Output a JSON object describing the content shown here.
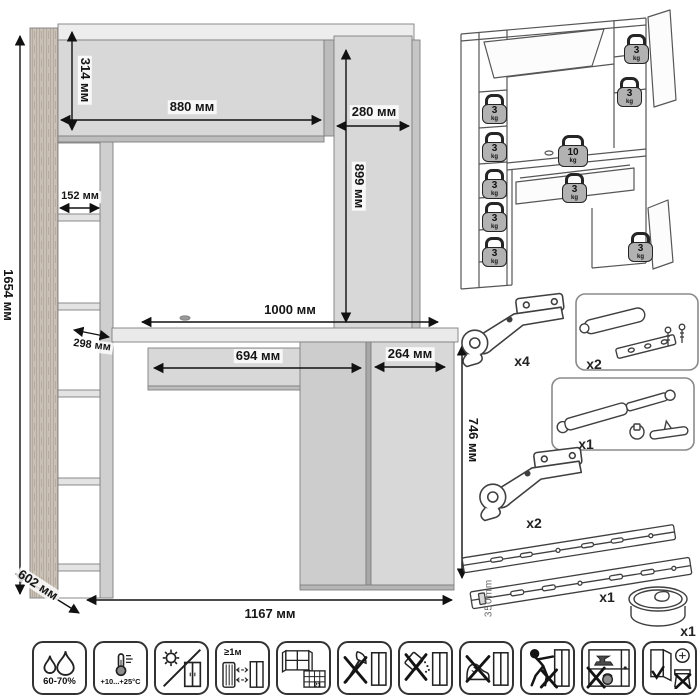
{
  "dims": {
    "total_height": "1654 мм",
    "hutch_height": "314 мм",
    "hutch_width": "880 мм",
    "cabinet_width": "280 мм",
    "shelf_width": "152 мм",
    "cabinet_height": "899 мм",
    "shelf_depth": "298 мм",
    "desktop_width": "1000 мм",
    "drawer_width": "694 мм",
    "pedestal_width": "264 мм",
    "desk_height": "746 мм",
    "depth": "602 мм",
    "total_width": "1167 мм"
  },
  "load": {
    "unit": "kg",
    "weights": [
      {
        "value": "3"
      },
      {
        "value": "3"
      },
      {
        "value": "3"
      },
      {
        "value": "3"
      },
      {
        "value": "3"
      },
      {
        "value": "3"
      },
      {
        "value": "3"
      },
      {
        "value": "10"
      },
      {
        "value": "3"
      },
      {
        "value": "3"
      }
    ]
  },
  "hw": {
    "hinge_top": {
      "count": "x4"
    },
    "damper": {
      "count": "x2"
    },
    "gas_lift": {
      "count": "x1"
    },
    "hinge_bottom": {
      "count": "x2"
    },
    "slides": {
      "count": "x1",
      "length": "350mm"
    },
    "grommet": {
      "count": "x1"
    }
  },
  "care": {
    "humidity": "60-70%",
    "temperature": "+10...+25°C",
    "min_distance": "≥1м",
    "calendar_day": "21"
  }
}
